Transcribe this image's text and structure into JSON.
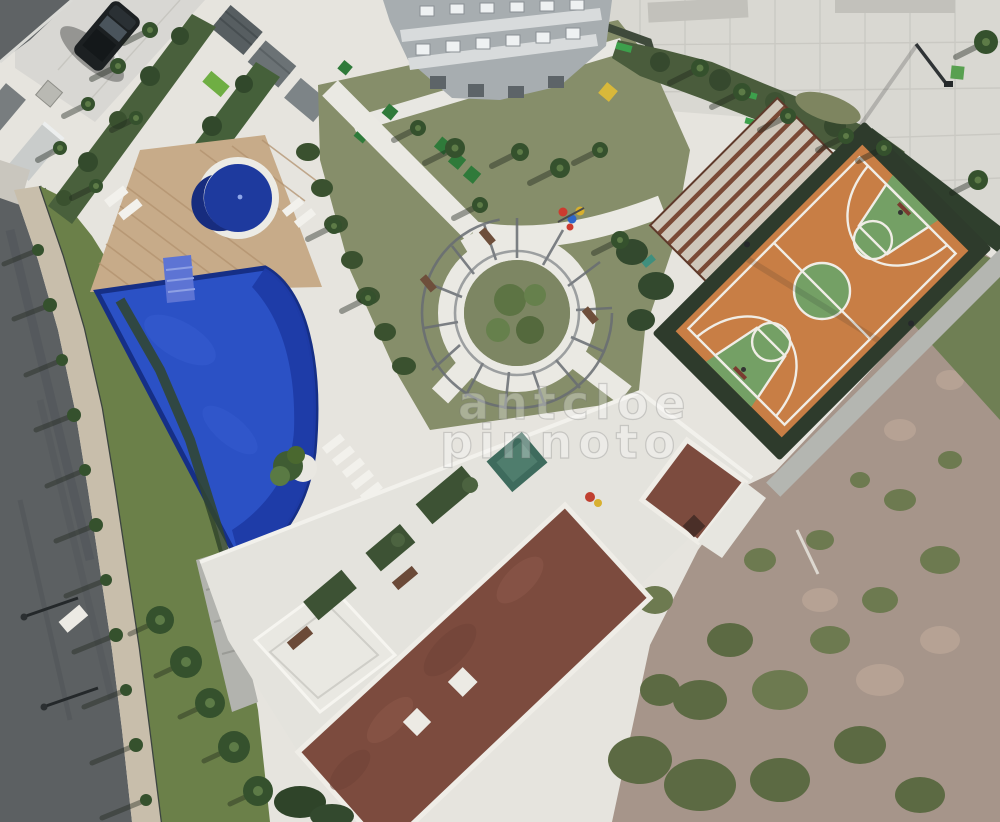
{
  "image": {
    "kind": "aerial drone photograph",
    "subject": "condominium leisure / common area seen from above",
    "contents": "swimming pools, wooden deck, circular pergola garden, basketball court, clubhouse roofs, paved plaza, lawns, palm trees, perimeter road with parked car"
  },
  "watermark": {
    "line1": "antcloe",
    "line2": "pinnoto",
    "style": "translucent outlined overlay text, two lines, center of image"
  },
  "features": [
    {
      "name": "main-pool",
      "color": "#2b51c5",
      "note": "large free-form blue pool with darker deep end and entry steps"
    },
    {
      "name": "round-pool",
      "color": "#1e3a9e",
      "note": "circular kids pool with white ring border on wooden deck"
    },
    {
      "name": "wooden-deck",
      "color": "#c7ab89",
      "note": "diagonal plank deck around round pool"
    },
    {
      "name": "basketball-court",
      "color": "#c87e45",
      "note": "orange court, green center circle and keys, white lines, dark fence"
    },
    {
      "name": "circular-pergola",
      "color": "#6b7076",
      "note": "spiral slatted pergola over round garden bed with palms"
    },
    {
      "name": "clubhouse-roof-main",
      "color": "#7c4b3e",
      "note": "long brown roof with white parapet and two roof hatches"
    },
    {
      "name": "clubhouse-roof-small",
      "color": "#7c4b3e",
      "note": "small brown roof with dark chimney"
    },
    {
      "name": "plaza",
      "color": "#d9d8d2",
      "note": "light paved plaza with expansion-joint grid and garden bed"
    },
    {
      "name": "apartment-building",
      "color": "#a7adb0",
      "note": "facade with window rows at top of frame"
    },
    {
      "name": "perimeter-road",
      "color": "#5c6062",
      "note": "asphalt road along left edge with sidewalk, fence and street trees"
    },
    {
      "name": "parked-suv",
      "color": "#1c2022",
      "note": "dark SUV in paved parking, top left"
    },
    {
      "name": "scrubland",
      "color": "#a6958a",
      "note": "unlandscaped lot, bottom right"
    },
    {
      "name": "sun-loungers",
      "color": "#f2f1ec",
      "note": "white loungers on pool paving"
    }
  ],
  "palette": {
    "paving_light": "#e6e4de",
    "plaza": "#d9d8d2",
    "road": "#5c6062",
    "sidewalk": "#c8beab",
    "lawn_olive": "#868e6a",
    "lawn_green": "#5e7a45",
    "hedge_dark": "#33492e",
    "pool_blue": "#2b51c5",
    "pool_deep": "#1d3ba6",
    "court_orange": "#c87e45",
    "court_green": "#74a065",
    "roof_brown": "#7c4b3e",
    "deck_wood": "#c7ab89",
    "scrub": "#a6958a"
  }
}
